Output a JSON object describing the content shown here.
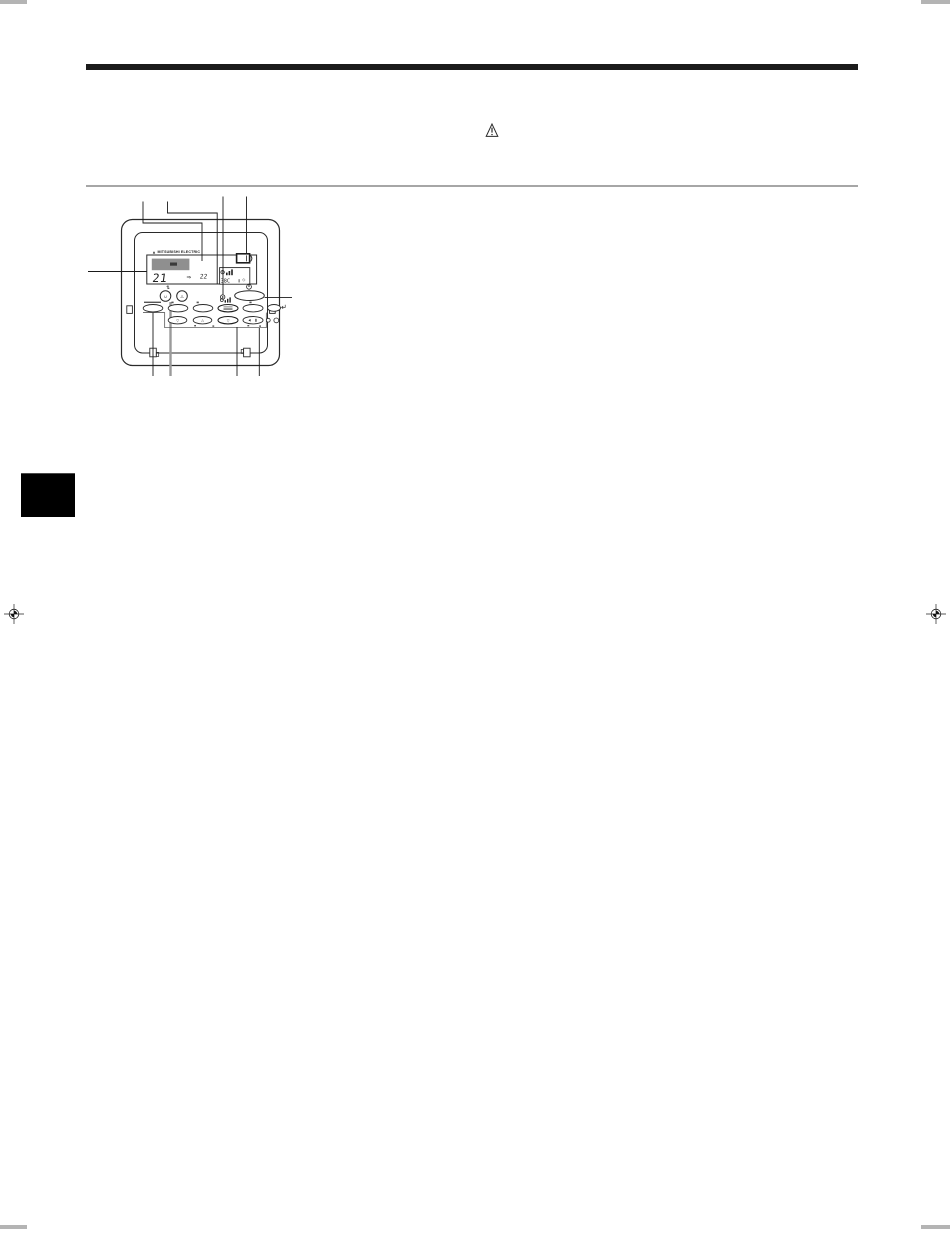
{
  "page": {
    "background": "#ffffff"
  },
  "print_marks": {
    "corner_color": "#b4b4b4",
    "registration_positions": [
      "left-middle",
      "right-middle"
    ]
  },
  "header": {
    "bar_color": "#1b1b1b"
  },
  "caution": {
    "symbol": "!"
  },
  "section_rule": {
    "color": "#a6a6a6"
  },
  "section_tab": {
    "color": "#000000"
  },
  "controller": {
    "brand": "MITSUBISHI ELECTRIC",
    "brand_mark": "▲",
    "lcd": {
      "set_temp": "21",
      "ghost_temp": "22",
      "filter_glyph": "⇒",
      "aux_readout": "38C",
      "diamond_glyph": "◇"
    },
    "buttons": {
      "updown_glyph": "⇅",
      "round1_glyph": "∪",
      "round2_glyph": "△",
      "rowB1_glyph": "▽",
      "rowB2_glyph": "△",
      "rowB3_glyph": "▽"
    },
    "icons": [
      "mitsubishi-logo",
      "louver-icon",
      "fan-speed-icon",
      "power-icon",
      "timer-clock-icon",
      "led-indicator",
      "caution-triangle-icon",
      "registration-mark"
    ]
  }
}
